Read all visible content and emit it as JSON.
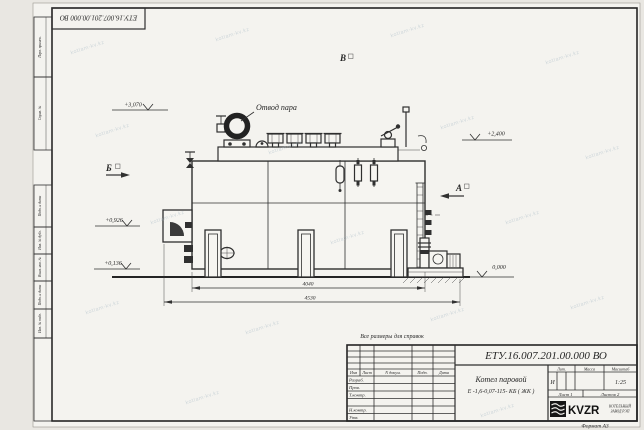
{
  "sheet": {
    "corner_stamp": "ЕТУ.16.007.201.00.000  ВО",
    "format_label": "Формат А3",
    "reference_note": "Все размеры для справок",
    "watermark": "kotlam-kv.kz",
    "margin_blocks": [
      {
        "label": "Перв. примен."
      },
      {
        "label": "Справ. №"
      },
      {
        "label": "Подп. и дата"
      },
      {
        "label": "Инв. № дубл."
      },
      {
        "label": "Взам. инв. №"
      },
      {
        "label": "Подп. и дата"
      },
      {
        "label": "Инв. № подл."
      }
    ]
  },
  "drawing": {
    "callout_steam_outlet": "Отвод пара",
    "elevation_top_left": "+3,070",
    "elevation_right": "+2,400",
    "elevation_left_mid": "+0,926",
    "elevation_left_low": "+0,136",
    "elevation_ground": "0,000",
    "view_left": "Б",
    "view_right": "А",
    "view_top": "В",
    "dim_inner": "4040",
    "dim_overall": "4530"
  },
  "title_block": {
    "doc_number": "ЕТУ.16.007.201.00.000  ВО",
    "product_name_line1": "Котел паровой",
    "product_name_line2": "Е -1,6-0,07-115- КБ ( ЖК )",
    "col_izm": "Изм",
    "col_list": "Лист",
    "col_ndokum": "N докум.",
    "col_podp": "Подп.",
    "col_data": "Дата",
    "row_razrab": "Разраб.",
    "row_prov": "Пров.",
    "row_tkontr": "Т.контр.",
    "row_nkontr": "Н.контр.",
    "row_utv": "Утв.",
    "hdr_lit": "Лит.",
    "hdr_massa": "Масса",
    "hdr_masshtab": "Масштаб",
    "lit_value": "И",
    "scale_value": "1:25",
    "sheet_no": "Лист 1",
    "sheets_total": "Листов 2",
    "logo_text": "KVZR",
    "company_line1": "КОТЕЛЬНЫЙ",
    "company_line2": "ЗАВОД РЭП"
  },
  "colors": {
    "ink": "#2f2f2f",
    "paper": "#f4f3ef",
    "watermark": "#9fb3c0"
  }
}
